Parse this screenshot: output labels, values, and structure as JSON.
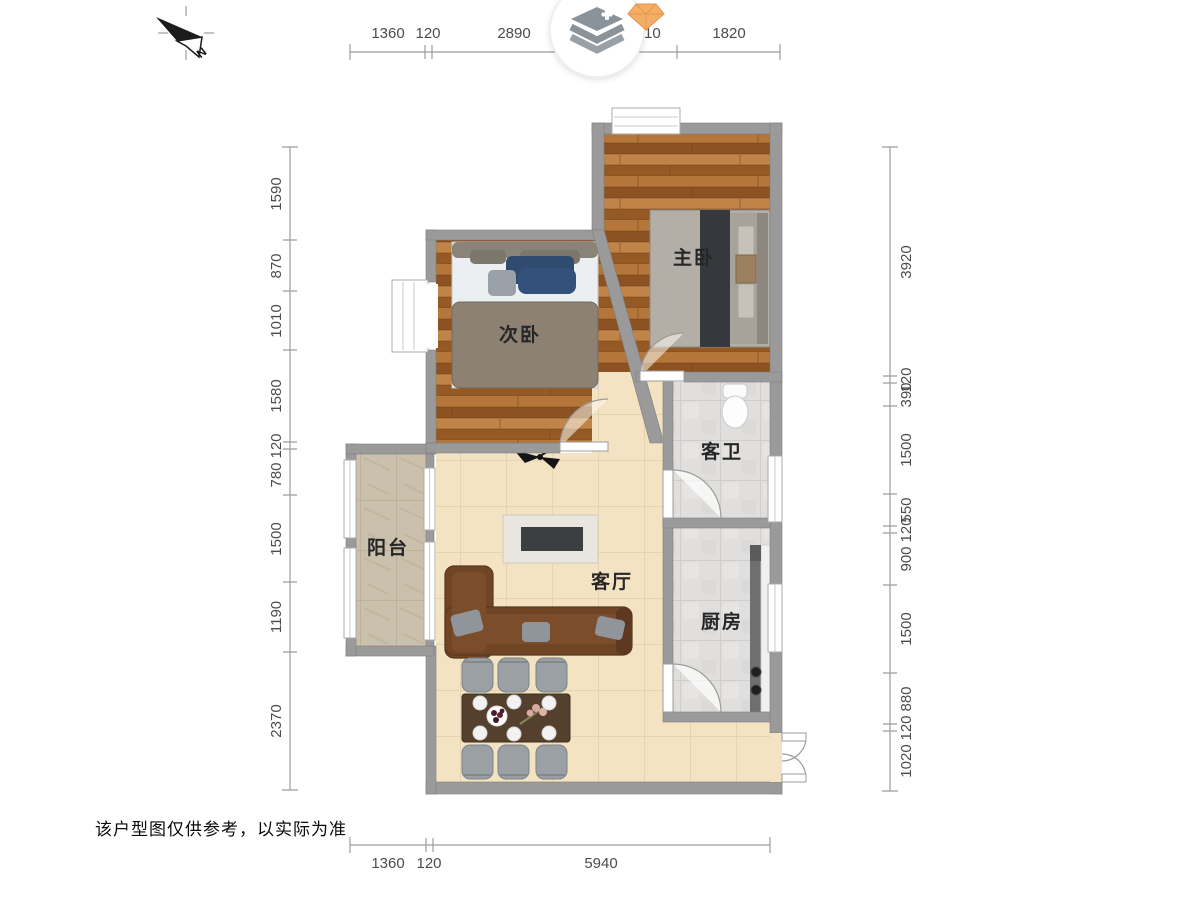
{
  "plan": {
    "rooms": {
      "master_bedroom": "主卧",
      "second_bedroom": "次卧",
      "guest_bathroom": "客卫",
      "kitchen": "厨房",
      "balcony": "阳台",
      "living_room": "客厅"
    },
    "disclaimer": "该户型图仅供参考，以实际为准",
    "compass": {
      "north_label": "N"
    }
  },
  "dimensions": {
    "top": [
      "1360",
      "120",
      "2890",
      "120",
      "200",
      "1010",
      "1820"
    ],
    "bottom": [
      "1360",
      "120",
      "5940"
    ],
    "left": [
      "1590",
      "870",
      "1010",
      "1580",
      "120",
      "780",
      "1500",
      "1190",
      "2370"
    ],
    "right": [
      "3920",
      "120",
      "390",
      "1500",
      "550",
      "120",
      "900",
      "1500",
      "880",
      "120",
      "1020"
    ]
  },
  "colors": {
    "wall": "#9a9a9a",
    "wood_floor": "#a5662c",
    "living_tile": "#f3e3c2",
    "gray_tile": "#e0dfdd",
    "balcony_tile": "#cac0ab",
    "sofa": "#6f4526",
    "dim_text": "#4c4c4c",
    "logo_gray": "#8a929a",
    "gem_orange": "#f4ad64"
  },
  "icons": {
    "logo": "layers-stack-icon",
    "gem": "gem-icon",
    "compass": "north-arrow-icon",
    "fan": "ceiling-fan-icon"
  }
}
